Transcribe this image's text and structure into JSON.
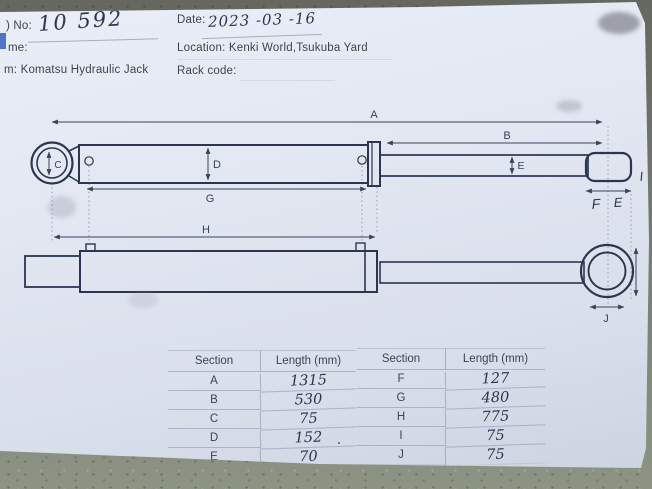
{
  "header": {
    "no_label": ") No:",
    "no_value": "10 592",
    "date_label": "Date:",
    "date_value": "2023 -03 -16",
    "name_label": "me:",
    "location_label": "Location: Kenki World,Tsukuba Yard",
    "item_label": "m: Komatsu Hydraulic Jack",
    "rack_label": "Rack code:"
  },
  "diagram": {
    "labels": {
      "A": "A",
      "B": "B",
      "C": "C",
      "D": "D",
      "E": "E",
      "G": "G",
      "H": "H",
      "J": "J"
    },
    "handwritten": {
      "F": "F",
      "E2": "E",
      "I": "I"
    }
  },
  "table": {
    "headers": [
      "Section",
      "Length (mm)"
    ],
    "left": [
      [
        "A",
        "1315"
      ],
      [
        "B",
        "530"
      ],
      [
        "C",
        "75"
      ],
      [
        "D",
        "152"
      ],
      [
        "E",
        "70"
      ]
    ],
    "right": [
      [
        "F",
        "127"
      ],
      [
        "G",
        "480"
      ],
      [
        "H",
        "775"
      ],
      [
        "I",
        "75"
      ],
      [
        "J",
        "75"
      ]
    ]
  }
}
